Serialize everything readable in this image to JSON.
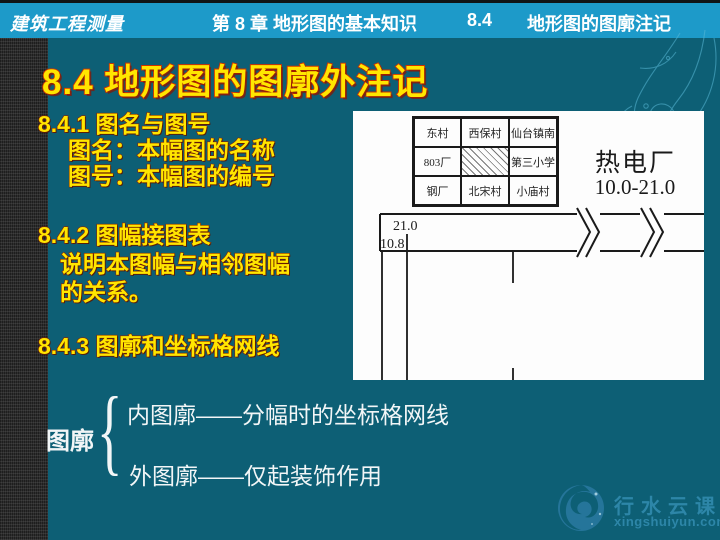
{
  "colors": {
    "slide_bg": "#0d5f75",
    "header_bg": "#1d9ac9",
    "heading_yellow": "#ffe600",
    "heading_outline": "#8a2300",
    "title_outline": "#d03000",
    "body_white": "#f2f6f7",
    "panel_bg": "#fdfdfd",
    "line_black": "#1a1a1a",
    "watermark_blue": "#2d86a8",
    "strip_gray": "#2e2e2e"
  },
  "header": {
    "course": "建筑工程测量",
    "chapter": "第 8 章  地形图的基本知识",
    "section_no": "8.4",
    "section_name": "地形图的图廓注记"
  },
  "title": "8.4   地形图的图廓外注记",
  "sections": [
    {
      "heading": "8.4.1   图名与图号",
      "lines": [
        "图名：本幅图的名称",
        "图号：本幅图的编号"
      ]
    },
    {
      "heading": "8.4.2   图幅接图表",
      "lines": [
        "说明本图幅与相邻图幅",
        "的关系。"
      ]
    },
    {
      "heading": "8.4.3  图廓和坐标格网线",
      "lines": []
    }
  ],
  "bracket": {
    "label": "图廓",
    "brace": "{",
    "items": [
      "内图廓——分幅时的坐标格网线",
      "外图廓——仅起装饰作用"
    ]
  },
  "diagram": {
    "adjoining_grid": [
      [
        "东村",
        "西保村",
        "仙台镇南"
      ],
      [
        "803厂",
        "",
        "第三小学"
      ],
      [
        "钢厂",
        "北宋村",
        "小庙村"
      ]
    ],
    "map_name": "热电厂",
    "map_number": "10.0-21.0",
    "north_coord": "21.0",
    "west_coord": "10.8"
  },
  "watermark": {
    "name": "行水云课",
    "site": "xingshuiyun.com"
  }
}
